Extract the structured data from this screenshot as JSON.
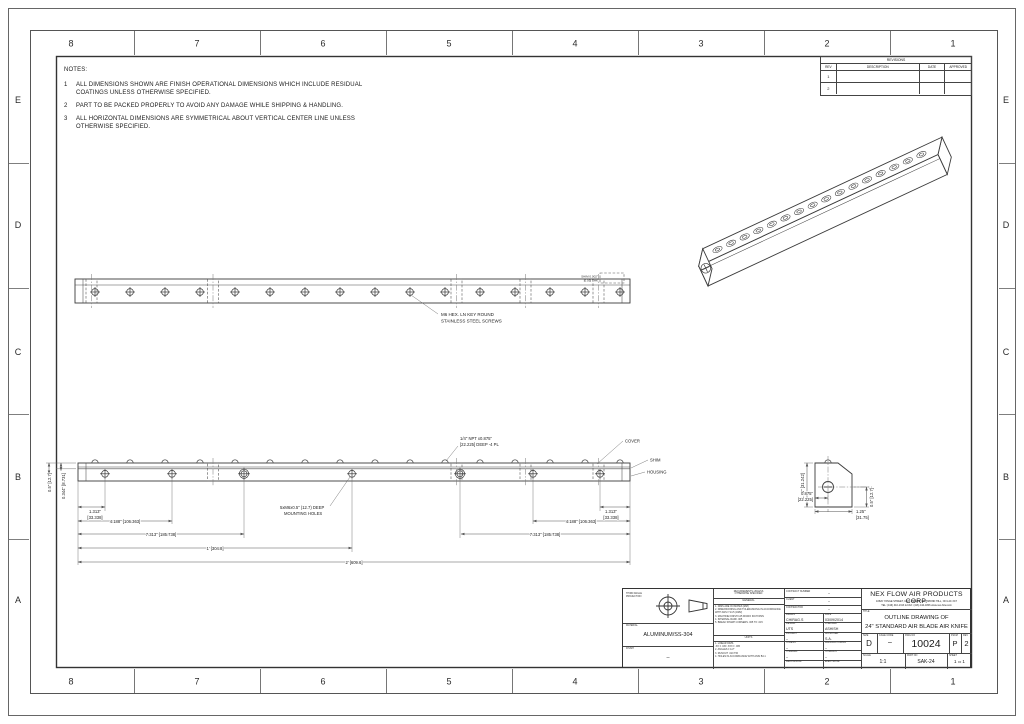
{
  "zones": {
    "cols": [
      "8",
      "7",
      "6",
      "5",
      "4",
      "3",
      "2",
      "1"
    ],
    "rows": [
      "E",
      "D",
      "C",
      "B",
      "A"
    ]
  },
  "notes": {
    "title": "NOTES:",
    "items": [
      {
        "num": "1",
        "text": "ALL DIMENSIONS SHOWN ARE FINISH OPERATIONAL DIMENSIONS WHICH INCLUDE RESIDUAL COATINGS UNLESS OTHERWISE SPECIFIED."
      },
      {
        "num": "2",
        "text": "PART TO BE PACKED PROPERLY TO AVOID ANY DAMAGE WHILE SHIPPING & HANDLING."
      },
      {
        "num": "3",
        "text": "ALL HORIZONTAL DIMENSIONS ARE SYMMETRICAL ABOUT VERTICAL CENTER LINE UNLESS OTHERWISE SPECIFIED."
      }
    ]
  },
  "revisions": {
    "title": "REVISIONS",
    "col_rev": "REV",
    "col_desc": "DESCRIPTION",
    "col_date": "DATE",
    "col_appr": "APPROVED",
    "rows": [
      "1",
      "2"
    ]
  },
  "front": {
    "note1": "M6 HEX. LN KEY ROUND",
    "note2": "STAINLESS STEEL SCREWS",
    "tiny1": "SHIM 0.002\"",
    "tiny2": "[0.05] THK"
  },
  "dims": {
    "in1313": "1.313\"",
    "mm1313": "[33.338]",
    "d4188": "4.188\" [106.363]",
    "d7313": "7.313\" [185.738]",
    "d1ft": "1' [304.8]",
    "d2ft": "2' [609.6]",
    "v05": "0.5\" [12.7]",
    "v0344": "0.344\" [8.731]",
    "npt1": "1/4\" NPT x0.875\"",
    "npt2": "[22.225] DEEP -4 PL",
    "mnt1": "5xM6x0.5\" (12.7) DEEP",
    "mnt2": "MOUNTING HOLES",
    "cover": "COVER",
    "shim": "SHIM",
    "housing": "HOUSING"
  },
  "endv": {
    "h": "1.23\" [31.242]",
    "w1in": "0.875\"",
    "w1mm": "[22.225]",
    "w2in": "1.25\"",
    "w2mm": "[31.75]",
    "r": "0.5\" [12.7]"
  },
  "tb": {
    "proj_label1": "THIRD ANGLE",
    "proj_label2": "PROJECTION",
    "material_label": "MATERIAL",
    "material": "ALUMINUM/SS-304",
    "finish_label": "FINISH",
    "finish": "–",
    "req1": "REQUIREMENTS-UNLESS",
    "req2": "OTHERWISE SPECIFIED",
    "general_label": "GENERAL",
    "gen": [
      "1. DIMS ARE IN INCHES [MM]",
      "2. DIMENSIONING AND TOLERANCING IN ACCORDANCE WITH ANSI Y14.5 (1982)",
      "3. MACHINE FINISH 125 MICRO INCH RMS",
      "4. INTERNAL RADII .005",
      "5. BREAK SHARP CORNERS .005 TO .015"
    ],
    "units_label": "UNITS",
    "units": [
      "1. LINEAR DIMS.",
      ".XX ± .030   .XXX ± .005",
      "2. ANGLES ± 1/2°",
      "3. RUNOUT .010 TIR",
      "4. HOLES IN ACCORDANCE WITH ANSI B4.1"
    ],
    "contract_label": "CONTRACT NUMBER",
    "contract_val": "–",
    "client_label": "CLIENT",
    "client_val": "–",
    "contractor_label": "CONTRACTOR",
    "contractor_val": "–",
    "grid": [
      {
        "l": "DRAWN",
        "lv": "CHIRAG.S",
        "r": "DATE",
        "rv": "03/09/2014"
      },
      {
        "l": "DESIGN",
        "lv": "UTS",
        "r": "CHECKED",
        "rv": "ASHISH"
      },
      {
        "l": "PROJECT",
        "lv": "–",
        "r": "APPROVED",
        "rv": "S.A."
      },
      {
        "l": "STRESS",
        "lv": "–",
        "r": "MANUFACTURING",
        "rv": "–"
      },
      {
        "l": "THERMAL",
        "lv": "–",
        "r": "SYMBOLS",
        "rv": "–"
      },
      {
        "l": "MECHANICAL",
        "lv": "–",
        "r": "ELECTRICAL",
        "rv": "–"
      }
    ],
    "company": "NEX FLOW AIR PRODUCTS CORP.",
    "address": "10520 YONGE STREET, UNIT 35B-220, RICHMOND HILL, ON L4C 3C7",
    "tel": "TEL: (416) 410-1313 & FAX: (416) 410-1806  www.nex-flow.com",
    "title_label": "TITLE",
    "title1": "OUTLINE DRAWING OF",
    "title2": "24\" STANDARD AIR BLADE AIR KNIFE",
    "size_label": "SIZE",
    "size": "D",
    "cage_label": "CAGE CODE",
    "cage": "–",
    "dwg_label": "DWG NO",
    "dwg_no": "10024",
    "fscm_label": "FSCM",
    "fscm": "P",
    "rev_label": "REV",
    "rev": "2",
    "scale_label": "SCALE",
    "scale": "1:1",
    "part_label": "PART NO",
    "part_no": "SAK-24",
    "sheet_label": "SHEET",
    "sheet_num": "1",
    "of_label": "OF",
    "of_num": "1"
  }
}
